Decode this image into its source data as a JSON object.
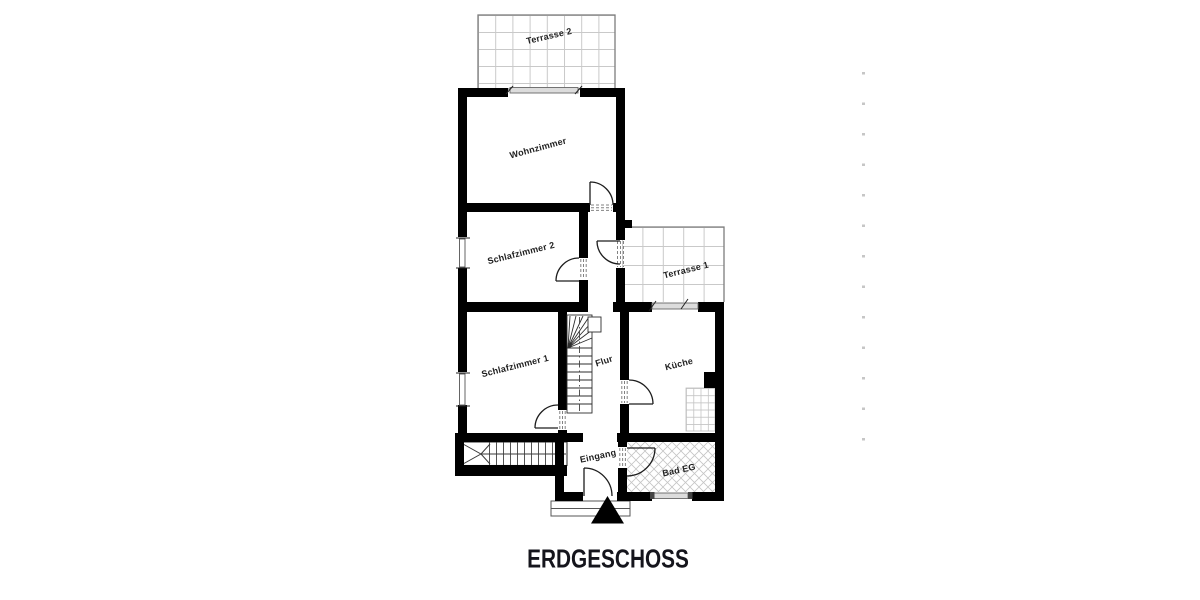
{
  "title": "ERDGESCHOSS",
  "rooms": {
    "terrasse2": "Terrasse 2",
    "wohnzimmer": "Wohnzimmer",
    "schlafzimmer2": "Schlafzimmer 2",
    "terrasse1": "Terrasse 1",
    "schlafzimmer1": "Schlafzimmer 1",
    "flur": "Flur",
    "kueche": "Küche",
    "eingang": "Eingang",
    "bad": "Bad EG"
  },
  "colors": {
    "wall": "#000000",
    "tile_grid_line": "#c9c9c9",
    "terrace_border": "#7d7d7d",
    "window_fill": "#dcdcdc",
    "door_line": "#1d1d1d",
    "label_text": "#1f1f1f",
    "title_text": "#15151c",
    "margin_mark": "#c6c6c6"
  }
}
